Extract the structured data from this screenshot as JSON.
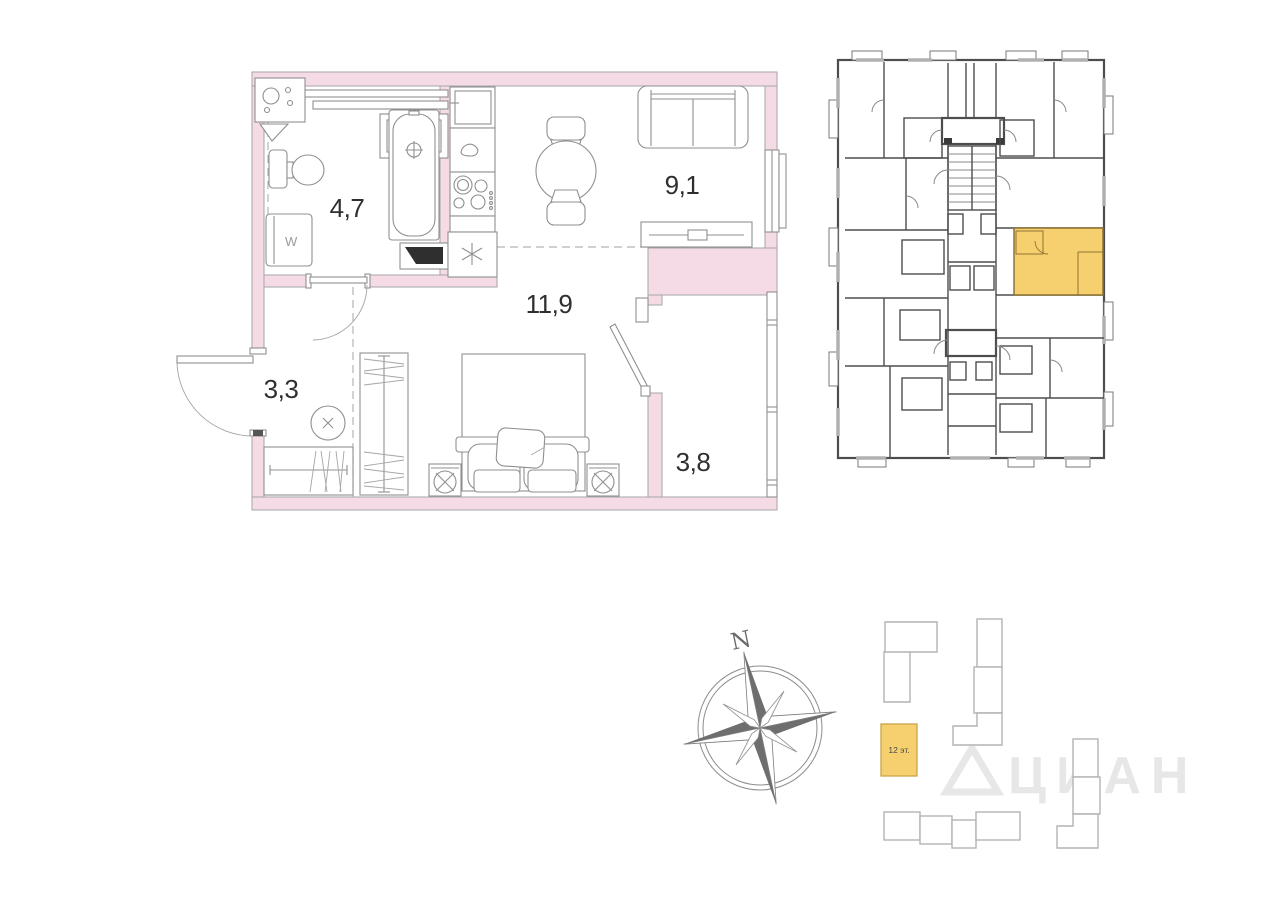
{
  "apartment_plan": {
    "wall_color": "#f5dbe6",
    "rooms": [
      {
        "id": "bathroom",
        "area_label": "4,7"
      },
      {
        "id": "hallway",
        "area_label": "3,3"
      },
      {
        "id": "living-room",
        "area_label": "11,9"
      },
      {
        "id": "kitchen-living-room",
        "area_label": "9,1"
      },
      {
        "id": "balcony",
        "area_label": "3,8"
      }
    ],
    "washer_glyph": "W"
  },
  "building_plan": {
    "highlight_color": "#f6d06e"
  },
  "site_plan": {
    "highlighted_building": {
      "label": "12 эт.",
      "color": "#f6d06e"
    }
  },
  "compass": {
    "north_label": "N"
  },
  "watermark": {
    "text": "ЦИАН"
  }
}
